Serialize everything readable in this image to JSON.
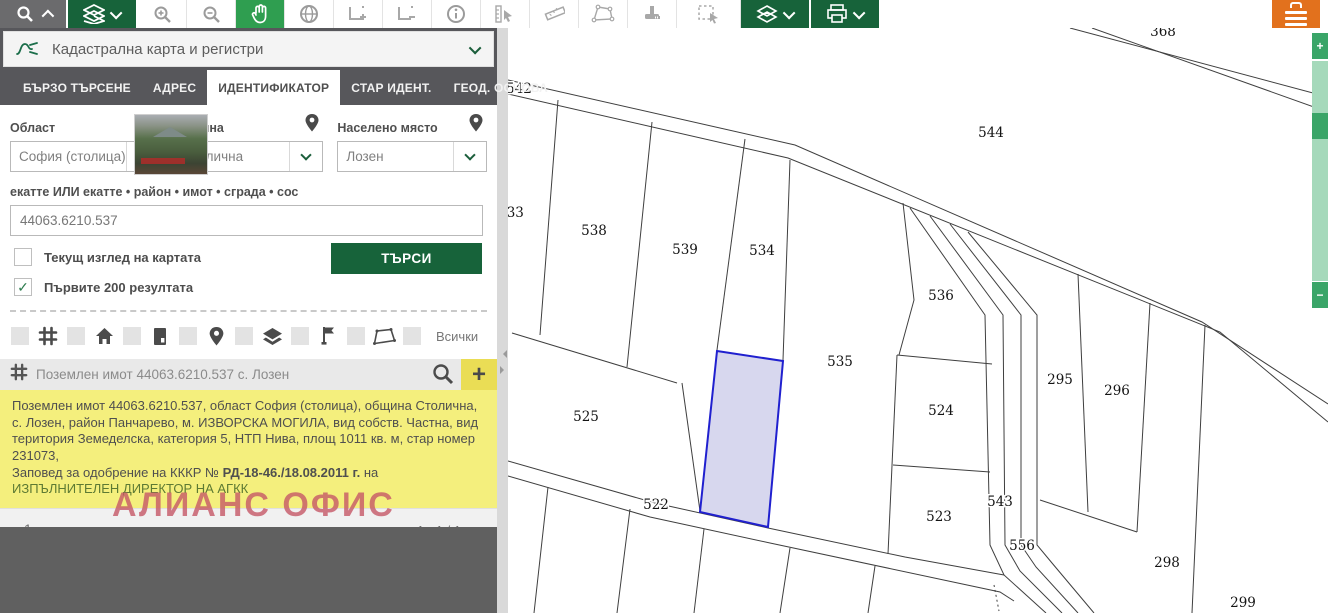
{
  "toolbar": {
    "buttons": [
      {
        "name": "search-panel-toggle",
        "icon": "search-icon"
      },
      {
        "name": "layers-menu",
        "icon": "layers-icon"
      },
      {
        "name": "zoom-in",
        "icon": "zoom-in-icon"
      },
      {
        "name": "zoom-out",
        "icon": "zoom-out-icon"
      },
      {
        "name": "pan",
        "icon": "hand-icon"
      },
      {
        "name": "full-extent",
        "icon": "globe-icon"
      },
      {
        "name": "previous-extent",
        "icon": "extent-plus-icon"
      },
      {
        "name": "next-extent",
        "icon": "extent-minus-icon"
      },
      {
        "name": "identify",
        "icon": "info-icon"
      },
      {
        "name": "measure-position",
        "icon": "pointer-measure-icon"
      },
      {
        "name": "measure-distance",
        "icon": "ruler-icon"
      },
      {
        "name": "measure-area",
        "icon": "polygon-measure-icon"
      },
      {
        "name": "stamp",
        "icon": "stamp-icon"
      },
      {
        "name": "select-region",
        "icon": "select-rect-icon"
      },
      {
        "name": "map-layers",
        "icon": "layers-icon"
      },
      {
        "name": "print",
        "icon": "printer-icon"
      },
      {
        "name": "main-menu",
        "icon": "menu-icon"
      }
    ]
  },
  "panel": {
    "header": {
      "title": "Кадастрална карта и регистри"
    },
    "tabs": [
      {
        "label": "БЪРЗО ТЪРСЕНЕ",
        "active": false
      },
      {
        "label": "АДРЕС",
        "active": false
      },
      {
        "label": "ИДЕНТИФИКАТОР",
        "active": true
      },
      {
        "label": "СТАР ИДЕНТ.",
        "active": false
      },
      {
        "label": "ГЕОД. ОСНОВА",
        "active": false
      }
    ],
    "form": {
      "fields": [
        {
          "label": "Област",
          "value": "София (столица)"
        },
        {
          "label": "Община",
          "value": "Столична"
        },
        {
          "label": "Населено място",
          "value": "Лозен"
        }
      ],
      "code_label": "екатте ИЛИ екатте • район • имот • сграда • сос",
      "code_value": "44063.6210.537",
      "checkboxes": [
        {
          "label": "Текущ изглед на картата",
          "checked": false,
          "glyph": ""
        },
        {
          "label": "Първите 200 резултата",
          "checked": true,
          "glyph": "✓"
        }
      ],
      "search_button": "ТЪРСИ"
    },
    "filters": {
      "icons": [
        "grid-icon",
        "home-icon",
        "building-icon",
        "pin-icon",
        "layers-icon",
        "flag-icon",
        "polygon-icon"
      ],
      "all_label": "Всички"
    },
    "result": {
      "title": "Поземлен имот 44063.6210.537 с. Лозен",
      "details_1": "Поземлен имот 44063.6210.537, област София (столица), община Столична, с. Лозен, район Панчарево, м. ИЗВОРСКА МОГИЛА, вид собств. Частна, вид територия Земеделска, категория 5, НТП Нива, площ 1011 кв. м, стар номер 231073,",
      "details_2_prefix": "Заповед за одобрение на КККР № ",
      "details_2_bold": "РД-18-46./18.08.2011 г.",
      "details_2_mid": " на ",
      "details_2_green": "ИЗПЪЛНИТЕЛЕН ДИРЕКТОР НА АГКК"
    },
    "pagination": {
      "page": "1",
      "range": "1 - 1 / 1"
    },
    "watermark": "АЛИАНС ОФИС"
  },
  "slider": {
    "plus": "+",
    "minus": "−"
  },
  "map": {
    "colors": {
      "line": "#3f3f3f",
      "highlight_stroke": "#2020cf",
      "highlight_fill": "rgba(175,175,222,0.5)",
      "label": "#141414"
    },
    "highlight": {
      "parcel": "537",
      "points": [
        [
          717,
          351
        ],
        [
          783,
          361
        ],
        [
          768,
          527
        ],
        [
          700,
          512
        ]
      ],
      "label_x": 742,
      "label_y": 441
    },
    "labels": [
      {
        "t": "368",
        "x": 1163,
        "y": 36
      },
      {
        "t": "542",
        "x": 519,
        "y": 93
      },
      {
        "t": "544",
        "x": 991,
        "y": 137
      },
      {
        "t": "533",
        "x": 511,
        "y": 217
      },
      {
        "t": "538",
        "x": 594,
        "y": 235
      },
      {
        "t": "539",
        "x": 685,
        "y": 254
      },
      {
        "t": "534",
        "x": 762,
        "y": 255
      },
      {
        "t": "536",
        "x": 941,
        "y": 300
      },
      {
        "t": "535",
        "x": 840,
        "y": 366
      },
      {
        "t": "295",
        "x": 1060,
        "y": 384
      },
      {
        "t": "296",
        "x": 1117,
        "y": 395
      },
      {
        "t": "525",
        "x": 586,
        "y": 421
      },
      {
        "t": "524",
        "x": 941,
        "y": 415
      },
      {
        "t": "522",
        "x": 656,
        "y": 509
      },
      {
        "t": "543",
        "x": 1000,
        "y": 506
      },
      {
        "t": "523",
        "x": 939,
        "y": 521
      },
      {
        "t": "556",
        "x": 1022,
        "y": 550
      },
      {
        "t": "298",
        "x": 1167,
        "y": 567
      },
      {
        "t": "299",
        "x": 1243,
        "y": 607
      }
    ],
    "lines": [
      [
        1070,
        28,
        1328,
        97
      ],
      [
        1092,
        28,
        1328,
        112
      ],
      [
        508,
        80,
        795,
        145,
        1202,
        322,
        1328,
        404
      ],
      [
        508,
        94,
        788,
        158,
        1220,
        332,
        1328,
        422
      ],
      [
        910,
        208,
        985,
        315,
        990,
        545,
        1004,
        575,
        1046,
        613
      ],
      [
        930,
        216,
        1003,
        315,
        1005,
        545,
        1020,
        571,
        1062,
        613
      ],
      [
        950,
        224,
        1021,
        315,
        1021,
        545,
        1036,
        567,
        1078,
        613
      ],
      [
        968,
        232,
        1037,
        315,
        1037,
        545,
        1052,
        563,
        1094,
        613
      ],
      [
        903,
        203,
        914,
        300,
        899,
        355
      ],
      [
        897,
        355,
        992,
        364
      ],
      [
        893,
        465,
        990,
        472
      ],
      [
        897,
        355,
        888,
        554
      ],
      [
        1078,
        274,
        1088,
        512
      ],
      [
        1040,
        500,
        1137,
        532
      ],
      [
        1150,
        303,
        1137,
        532
      ],
      [
        1205,
        325,
        1192,
        613
      ],
      [
        508,
        461,
        655,
        503,
        768,
        528,
        905,
        557,
        1004,
        575
      ],
      [
        508,
        476,
        650,
        517,
        770,
        543,
        1000,
        592,
        1014,
        601
      ],
      [
        512,
        333,
        677,
        383
      ],
      [
        682,
        383,
        700,
        511
      ],
      [
        558,
        100,
        540,
        335
      ],
      [
        652,
        122,
        627,
        367
      ],
      [
        745,
        139,
        717,
        350
      ],
      [
        790,
        160,
        783,
        360
      ],
      [
        548,
        487,
        534,
        613
      ],
      [
        630,
        509,
        617,
        613
      ],
      [
        704,
        529,
        694,
        613
      ],
      [
        790,
        548,
        780,
        613
      ],
      [
        875,
        566,
        868,
        613
      ]
    ],
    "dashed": [
      [
        994,
        585,
        999,
        611
      ]
    ]
  }
}
